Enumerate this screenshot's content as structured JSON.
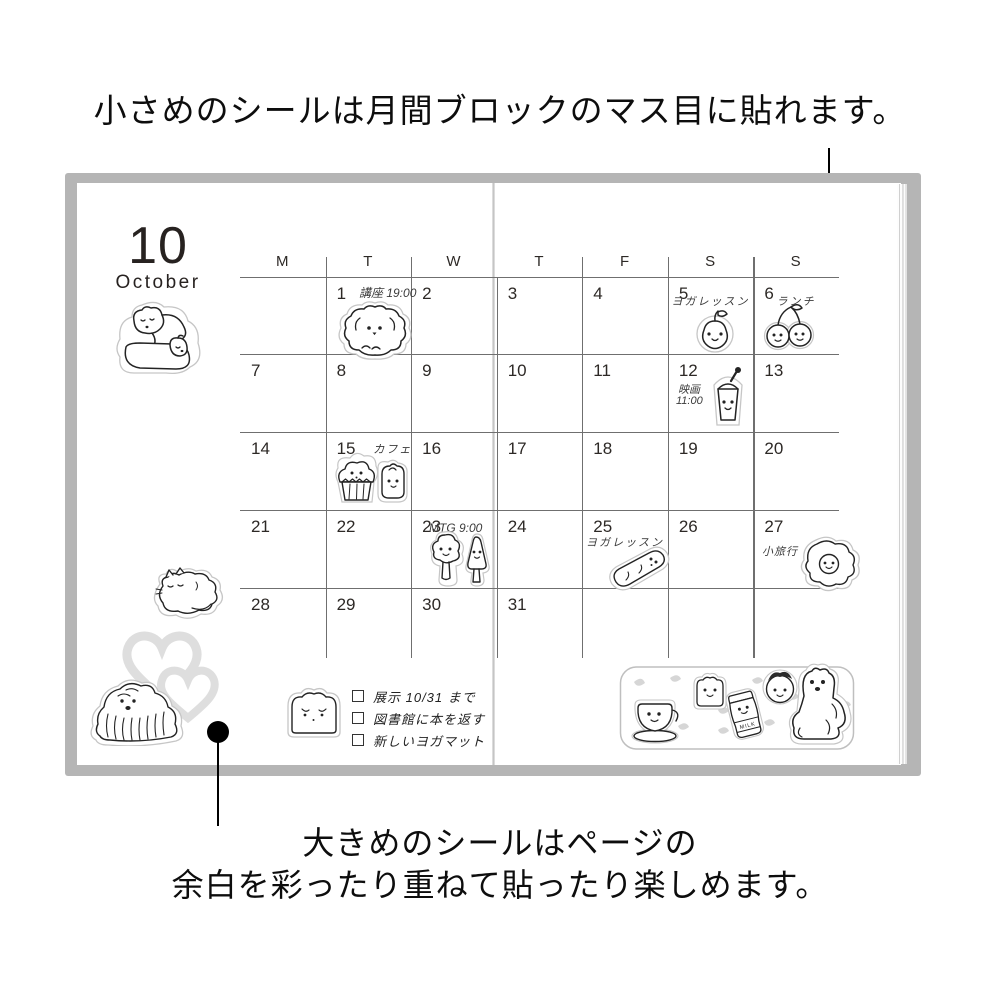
{
  "captions": {
    "top": "小さめのシールは月間ブロックのマス目に貼れます。",
    "bottom_line1": "大きめのシールはページの",
    "bottom_line2": "余白を彩ったり重ねて貼ったり楽しめます。"
  },
  "calendar": {
    "month_number": "10",
    "month_name": "October",
    "day_headers": [
      "M",
      "T",
      "W",
      "T",
      "F",
      "S",
      "S"
    ],
    "weeks": [
      [
        "",
        "1",
        "2",
        "3",
        "4",
        "5",
        "6"
      ],
      [
        "7",
        "8",
        "9",
        "10",
        "11",
        "12",
        "13"
      ],
      [
        "14",
        "15",
        "16",
        "17",
        "18",
        "19",
        "20"
      ],
      [
        "21",
        "22",
        "23",
        "24",
        "25",
        "26",
        "27"
      ],
      [
        "28",
        "29",
        "30",
        "31",
        "",
        "",
        ""
      ]
    ],
    "notes": {
      "oct1": "講座 19:00",
      "oct5": "ヨガレッスン",
      "oct6": "ランチ",
      "oct12_l1": "映画",
      "oct12_l2": "11:00",
      "oct15": "カフェ",
      "oct23": "MTG 9:00",
      "oct25": "ヨガレッスン",
      "oct27": "小旅行"
    }
  },
  "checklist": {
    "items": [
      "展示 10/31 まで",
      "図書館に本を返す",
      "新しいヨガマット"
    ]
  },
  "sticker_strip": {
    "milk_label": "MILK"
  },
  "stickers": {
    "page_large": [
      "polar-bears",
      "sleeping-cat",
      "gray-hearts",
      "shaggy-dog",
      "bread-slice",
      "sticker-sheet-strip"
    ],
    "calendar_small": [
      "poodle-dog",
      "apple",
      "cherries",
      "movie-drink-cup",
      "cupcake",
      "bread-bun",
      "two-trees",
      "lying-bread",
      "fried-egg"
    ],
    "strip_items": [
      "coffee-cup",
      "toast",
      "milk-jar",
      "strawberry",
      "sitting-bear"
    ]
  },
  "colors": {
    "cover_gray": "#b5b5b5",
    "grid_line": "#6f6f6f",
    "ink": "#111111",
    "sticker_edge": "#c6c6c6",
    "heart_gray": "#dedede",
    "confetti_gray": "#d6d6d6"
  }
}
